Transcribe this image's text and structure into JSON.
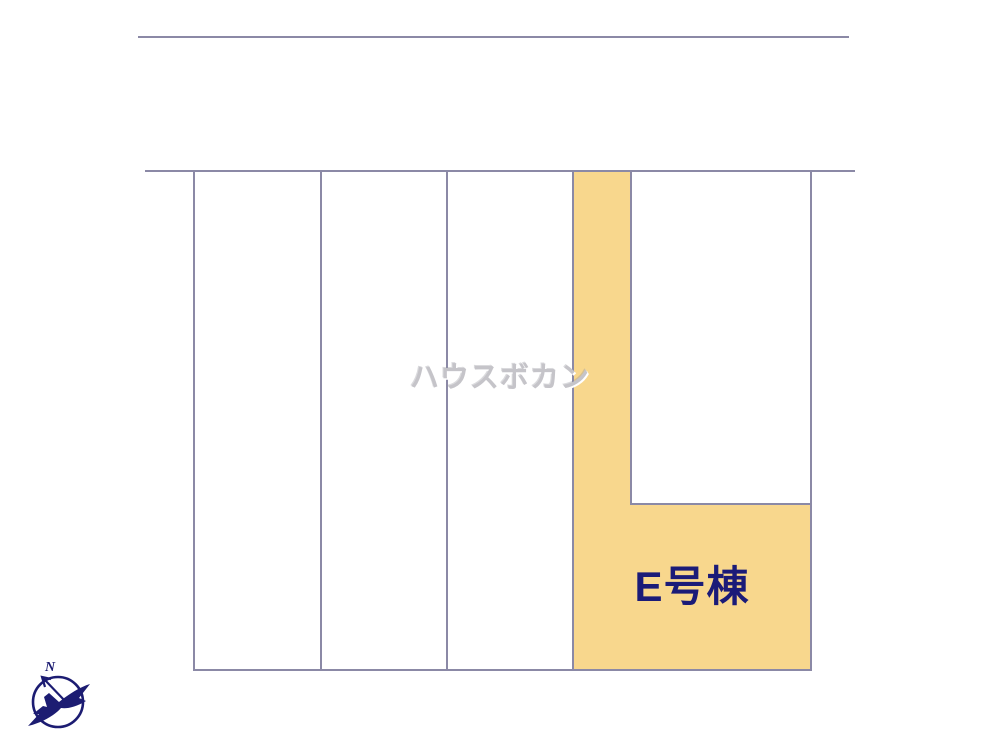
{
  "colors": {
    "background": "#ffffff",
    "line": "#8b89a6",
    "highlight": "#f8d78d",
    "label": "#1b1b78",
    "watermark": "#c5c4c9",
    "compass": "#1c1c72"
  },
  "site_plan": {
    "watermark_text": "ハウスボカン",
    "highlighted_unit": {
      "label": "E号棟"
    },
    "compass": {
      "north_label": "N"
    }
  }
}
